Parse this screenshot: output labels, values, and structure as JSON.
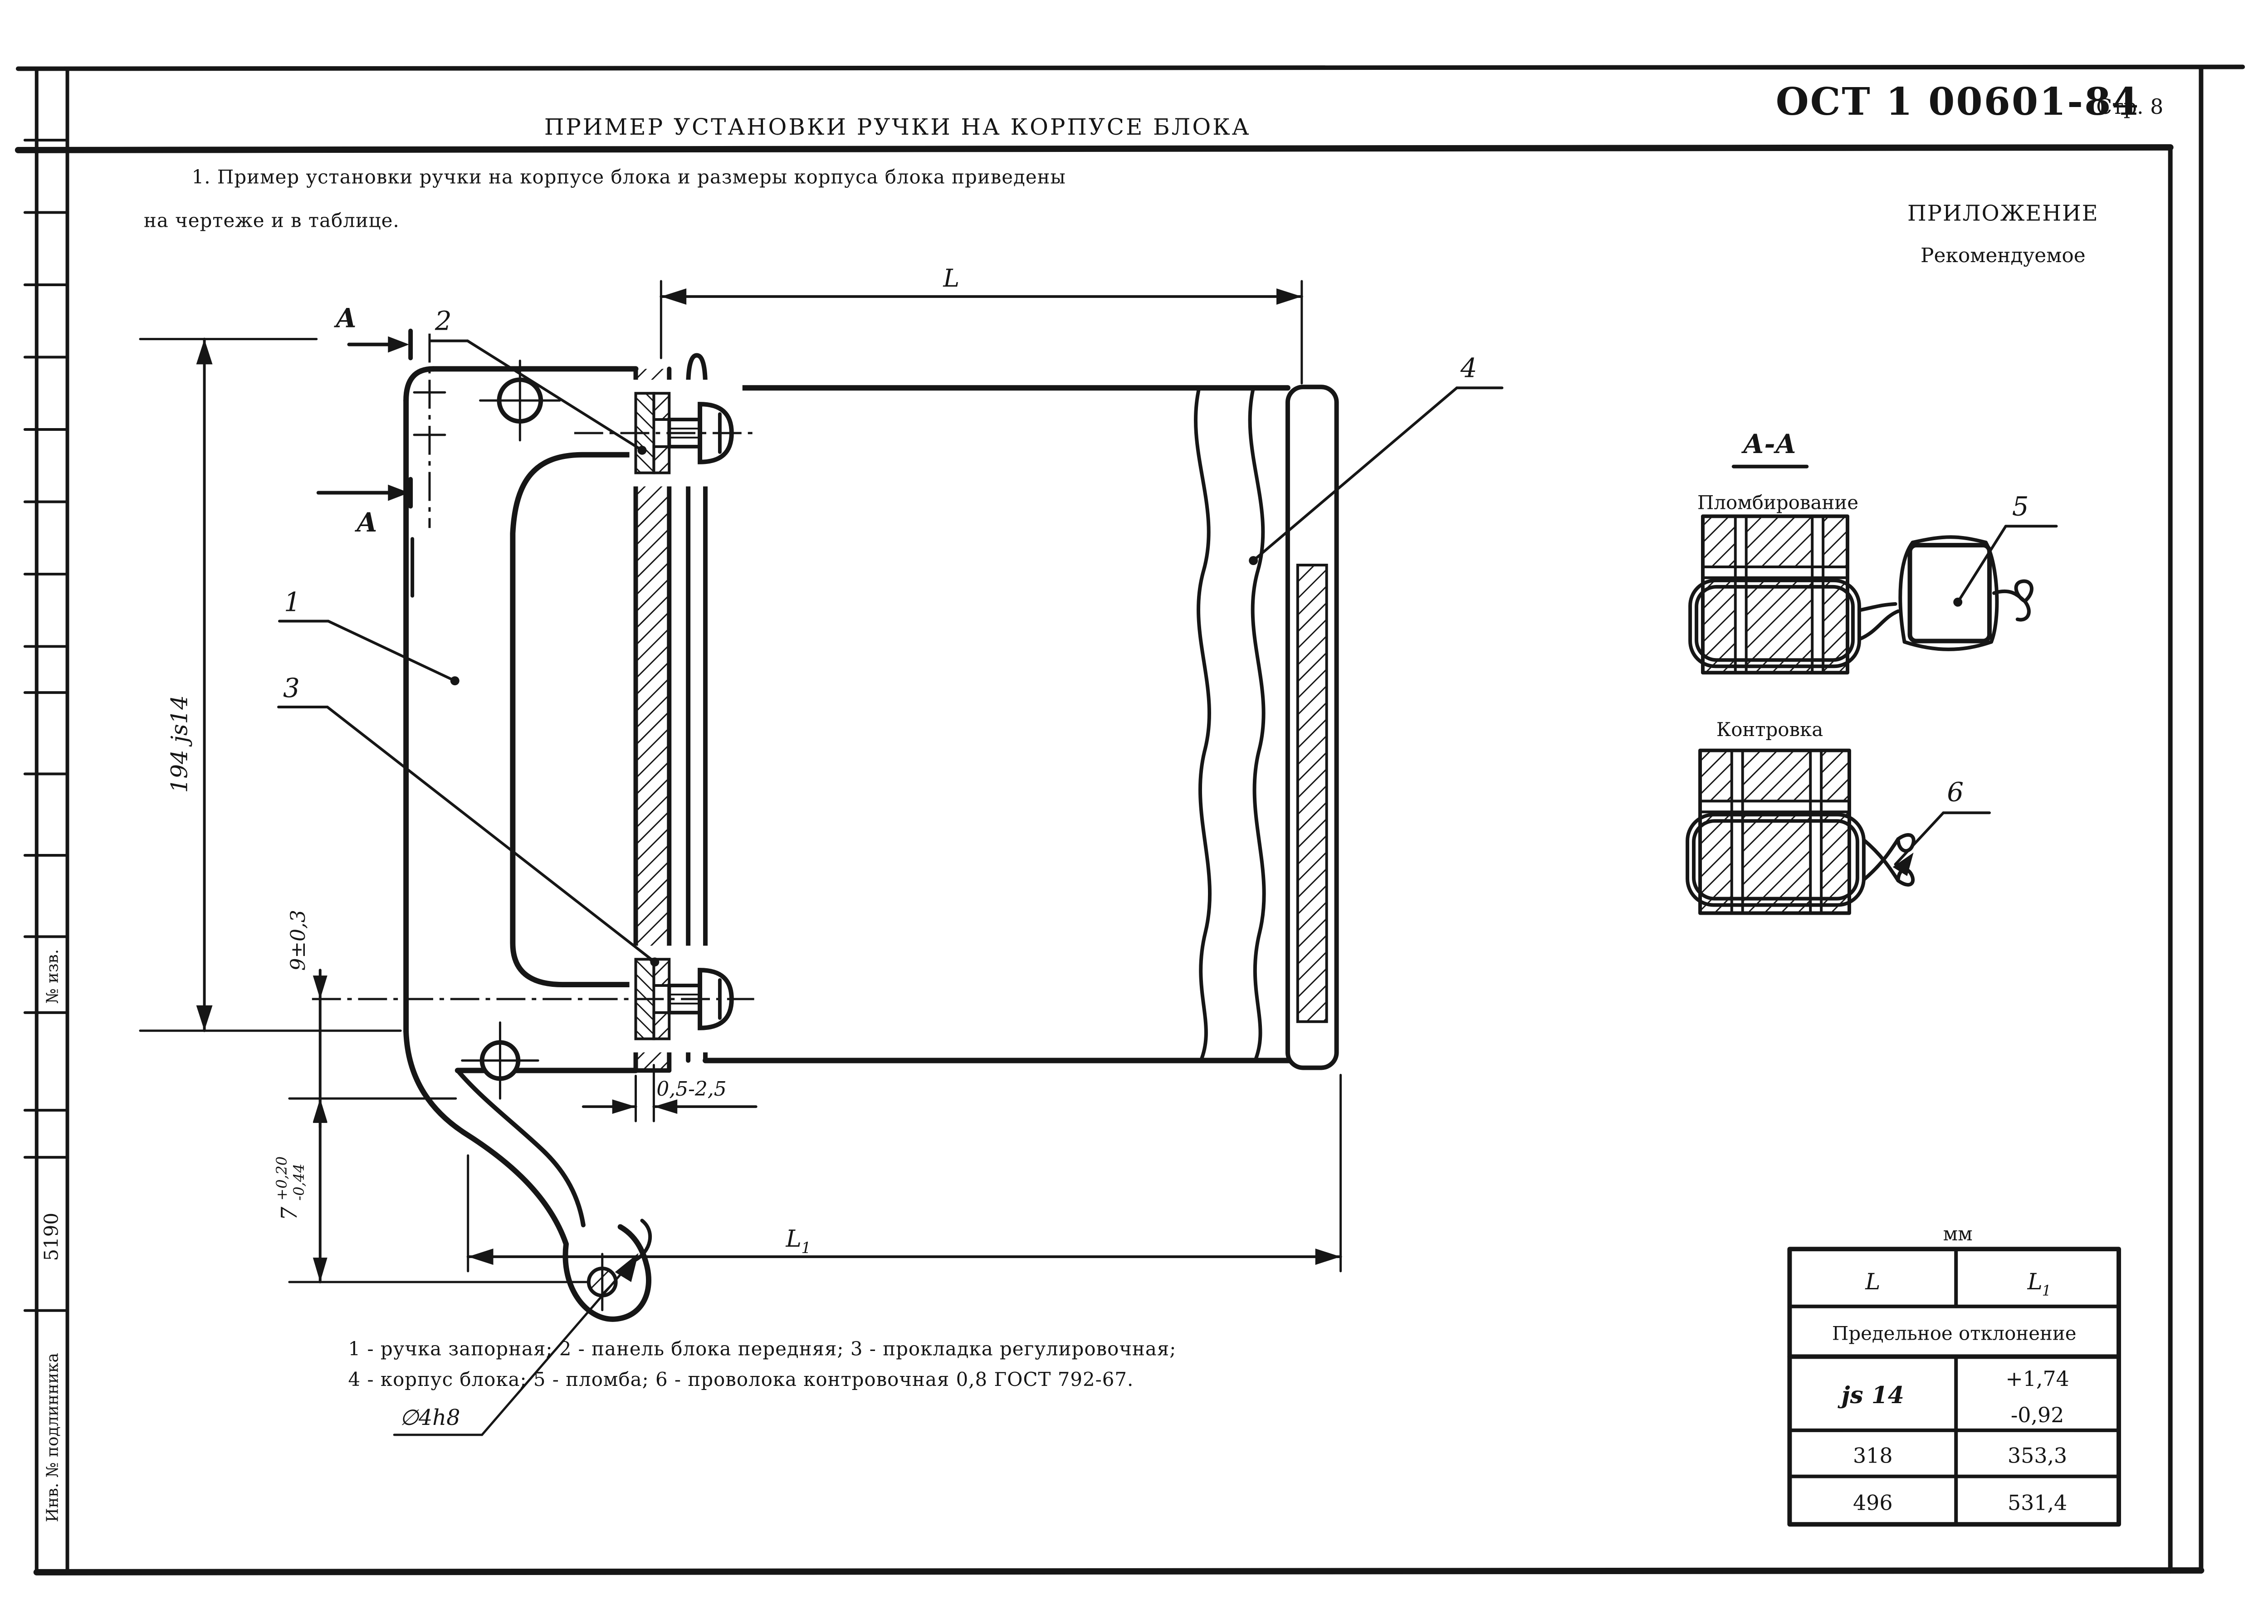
{
  "header": {
    "doc_number": "ОСТ 1 00601-84",
    "page": "Стр. 8",
    "appendix": "ПРИЛОЖЕНИЕ",
    "appendix_type": "Рекомендуемое",
    "title": "ПРИМЕР УСТАНОВКИ РУЧКИ НА КОРПУСЕ БЛОКА"
  },
  "intro": {
    "line1": "1. Пример установки ручки на корпусе блока и размеры корпуса блока приведены",
    "line2": "на чертеже и в таблице."
  },
  "legend": {
    "line1": "1 - ручка запорная; 2 - панель блока передняя; 3 - прокладка регулировочная;",
    "line2": "4 - корпус блока; 5 - пломба; 6 - проволока контровочная 0,8 ГОСТ 792-67."
  },
  "margin_stamps": {
    "izv": "№ изв.",
    "code": "5190",
    "inv": "Инв. № подлинника"
  },
  "drawing": {
    "section_letter": "А",
    "callout_1": "1",
    "callout_2": "2",
    "callout_3": "3",
    "callout_4": "4",
    "callout_5": "5",
    "callout_6": "6",
    "dim_height": "194 js14",
    "dim_9": "9±0,3",
    "dim_7": "7",
    "dim_7_plus": "+0,20",
    "dim_7_minus": "-0,44",
    "dim_hole": "∅4h8",
    "dim_gap": "0,5-2,5",
    "dim_L": "L",
    "dim_L1_main": "L",
    "dim_L1_sub": "1",
    "section_view": "А-А",
    "sealing": "Пломбирование",
    "locking": "Контровка"
  },
  "table": {
    "units": "мм",
    "col_L": "L",
    "col_L1_main": "L",
    "col_L1_sub": "1",
    "span_header": "Предельное отклонение",
    "fit": "js 14",
    "dev_plus": "+1,74",
    "dev_minus": "-0,92",
    "r2c1": "318",
    "r2c2": "353,3",
    "r3c1": "496",
    "r3c2": "531,4"
  }
}
